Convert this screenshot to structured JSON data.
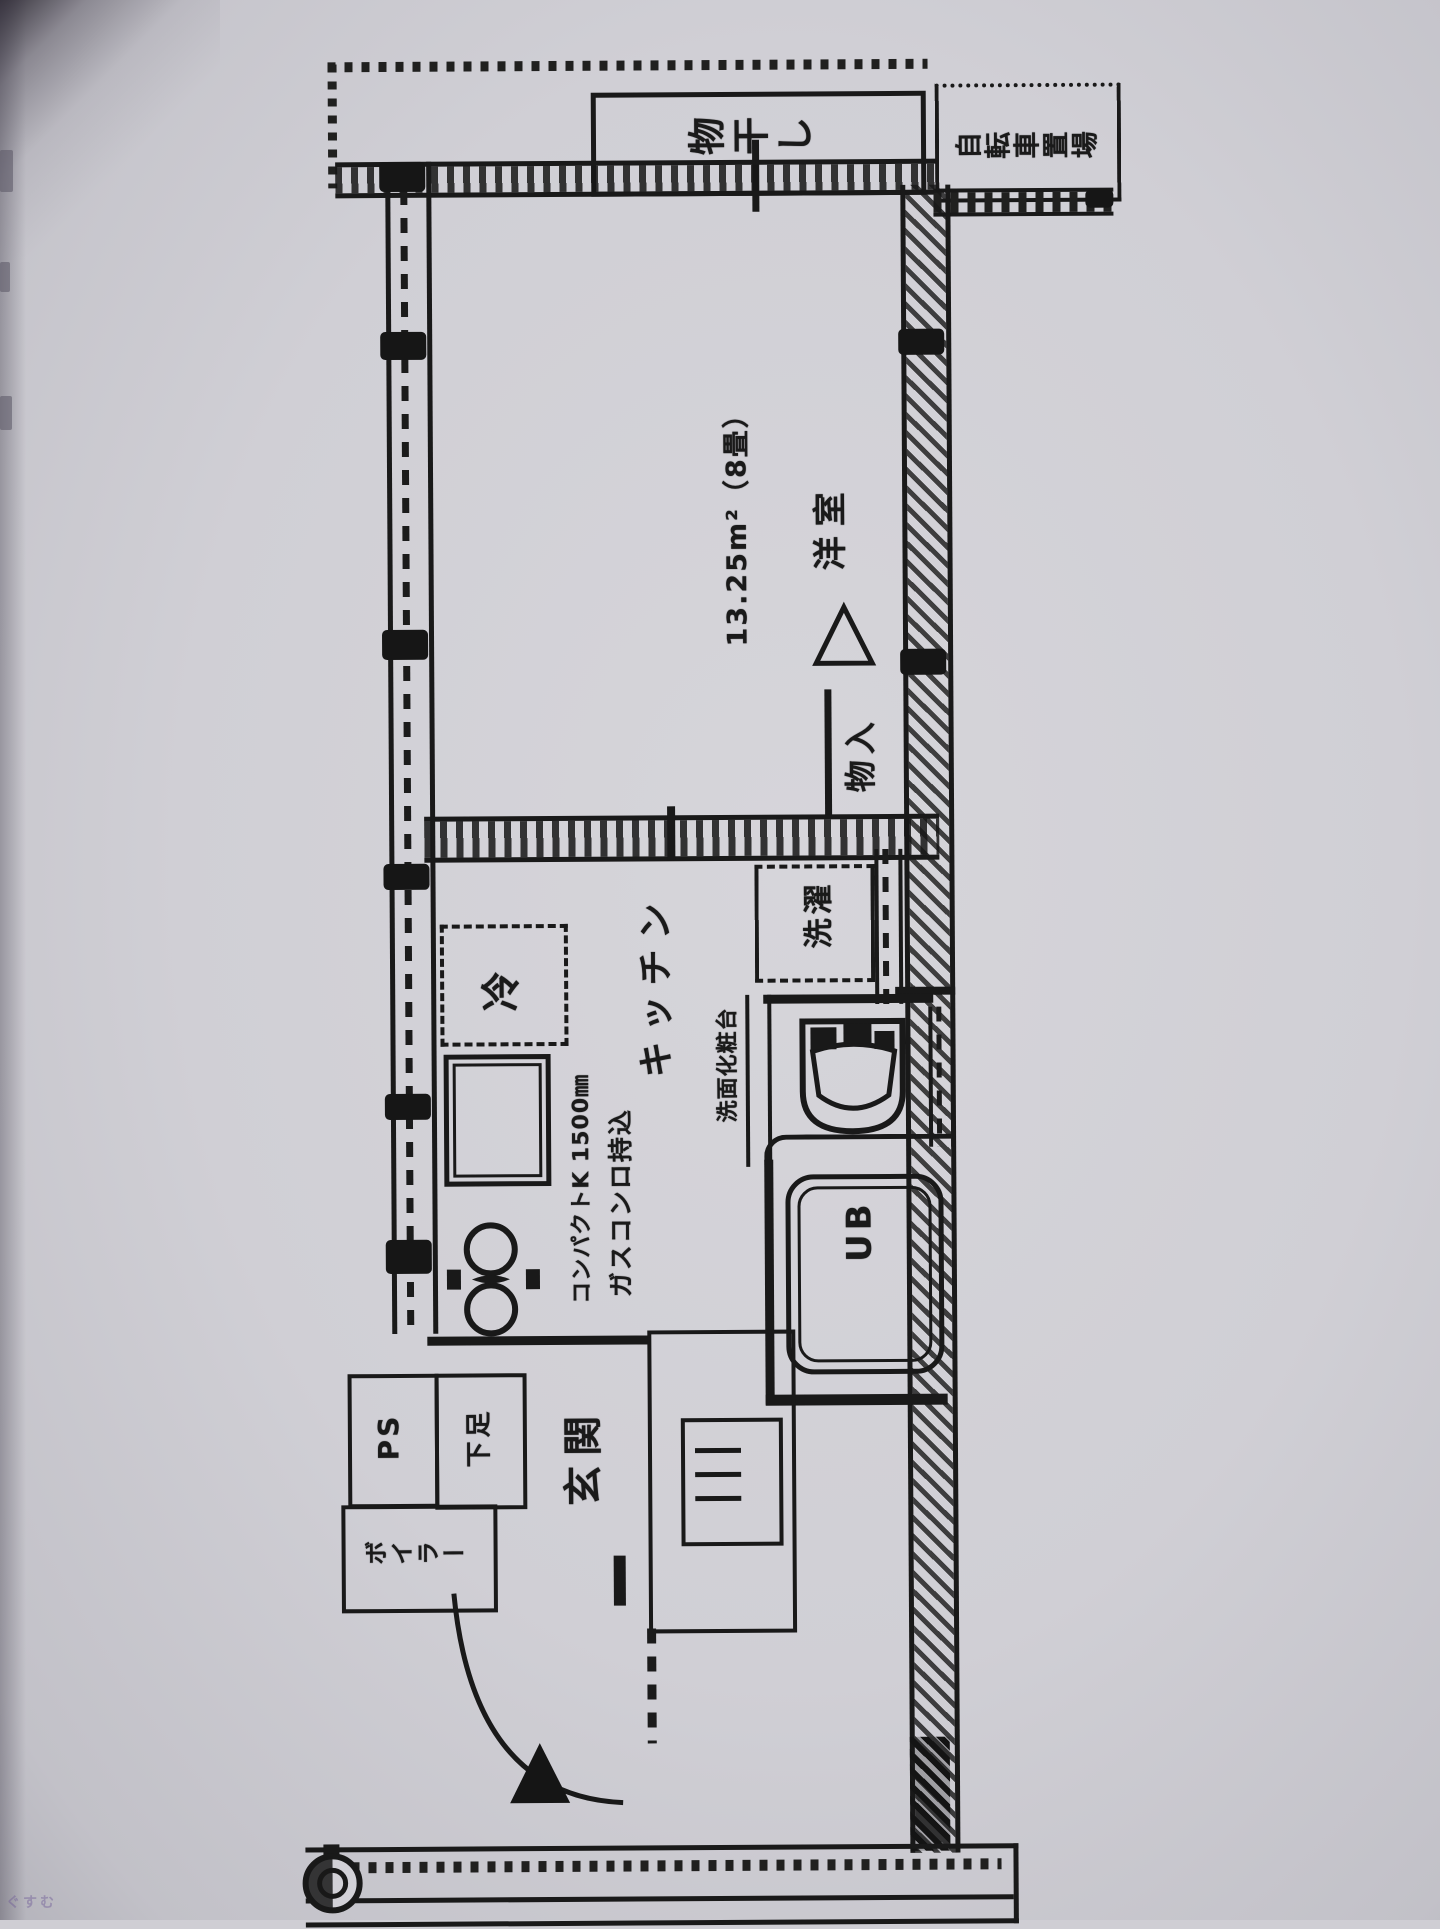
{
  "document": {
    "kind": "apartment floor plan (photocopied page, rotated 90°)",
    "ink_color": "#191919",
    "paper_color": "#d0cfd5"
  },
  "labels": {
    "drying": "物干し",
    "bicycle_parking": "自転車置場",
    "room_area": "13.25m²（8畳）",
    "room_name": "洋室",
    "closet": "物入",
    "laundry": "洗濯",
    "fridge": "冷",
    "kitchen": "キッチン",
    "compact_kitchen": "コンパクトK 1500㎜",
    "gas_stove": "ガスコンロ持込",
    "vanity": "洗面化粧台",
    "unit_bath": "UB",
    "pipe_space": "PS",
    "shoe_box": "下足",
    "boiler": "ボイラー",
    "entrance": "玄関",
    "watermark": "ぐすむ"
  },
  "fixtures": [
    "drying-bar",
    "refrigerator-space",
    "kitchen-sink",
    "two-burner-stove",
    "washing-machine-space",
    "toilet",
    "bathtub",
    "entrance-door-swing",
    "entrance-arrow",
    "water-meter"
  ]
}
